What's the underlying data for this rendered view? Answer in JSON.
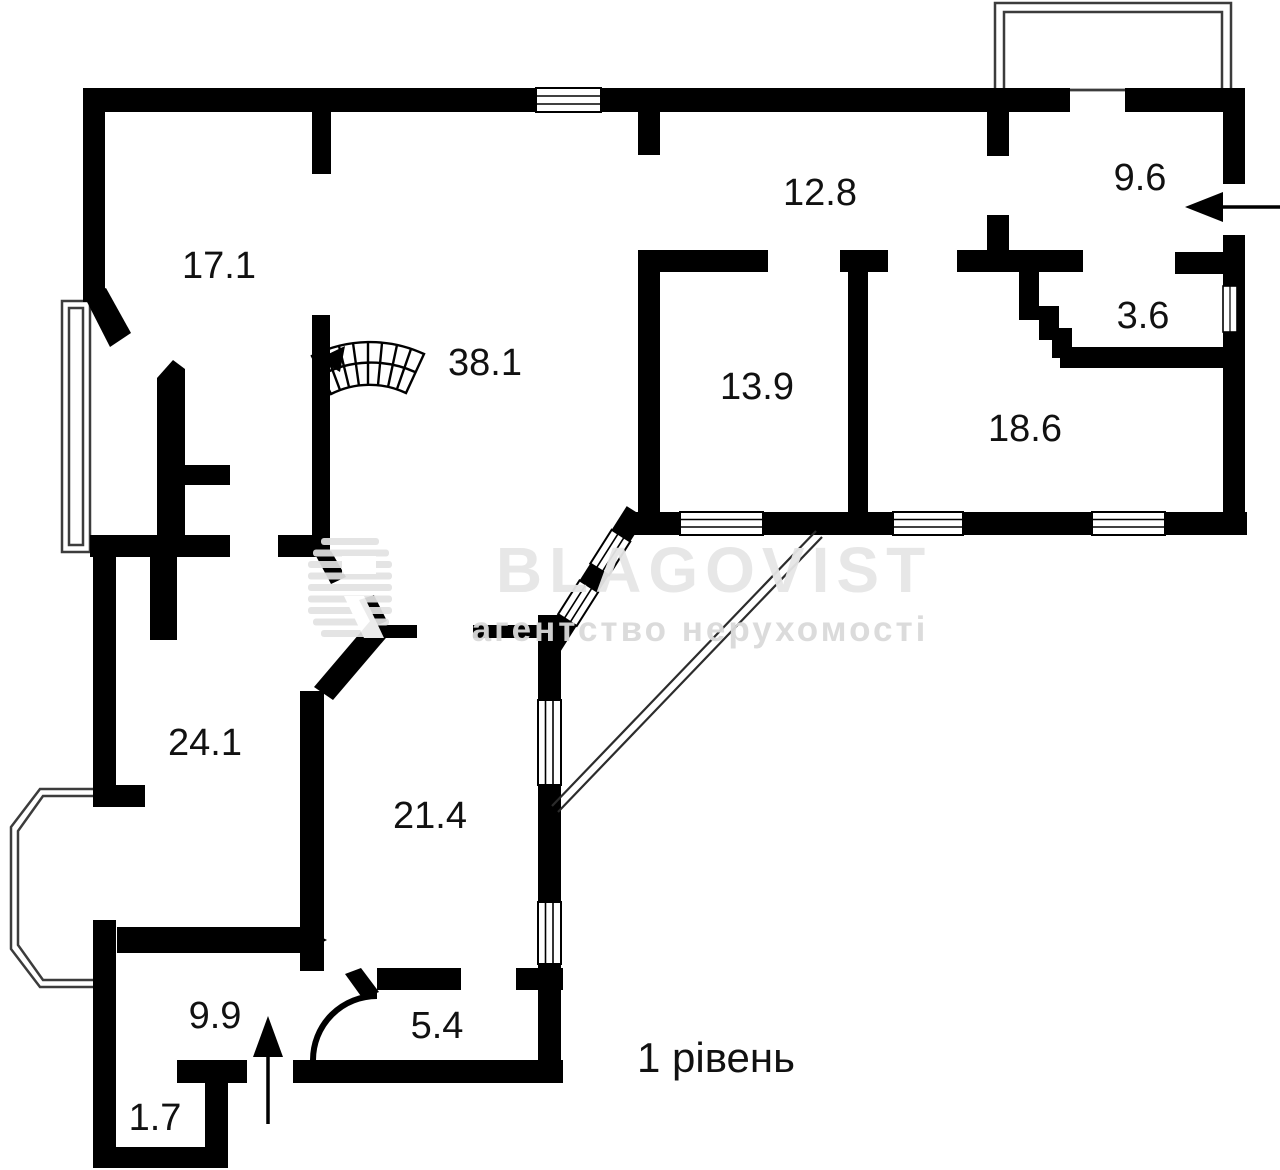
{
  "plan": {
    "level_label": "1 рівень",
    "watermark": {
      "brand": "BLAGOVIST",
      "subtitle": "агентство нерухомості"
    },
    "rooms": [
      {
        "name": "room-17-1",
        "area": "17.1"
      },
      {
        "name": "room-38-1",
        "area": "38.1"
      },
      {
        "name": "room-12-8",
        "area": "12.8"
      },
      {
        "name": "room-9-6",
        "area": "9.6"
      },
      {
        "name": "room-3-6",
        "area": "3.6"
      },
      {
        "name": "room-13-9",
        "area": "13.9"
      },
      {
        "name": "room-18-6",
        "area": "18.6"
      },
      {
        "name": "room-24-1",
        "area": "24.1"
      },
      {
        "name": "room-21-4",
        "area": "21.4"
      },
      {
        "name": "room-9-9",
        "area": "9.9"
      },
      {
        "name": "room-5-4",
        "area": "5.4"
      },
      {
        "name": "room-1-7",
        "area": "1.7"
      }
    ],
    "colors": {
      "wall": "#000000",
      "background": "#ffffff",
      "label": "#111111",
      "watermark": "#e6e6e6",
      "watermark_subtitle": "#dadada"
    },
    "icons": {
      "staircase": "winder-stair-fan",
      "entrance_right": "arrow-left",
      "entrance_bottom": "arrow-up"
    }
  }
}
